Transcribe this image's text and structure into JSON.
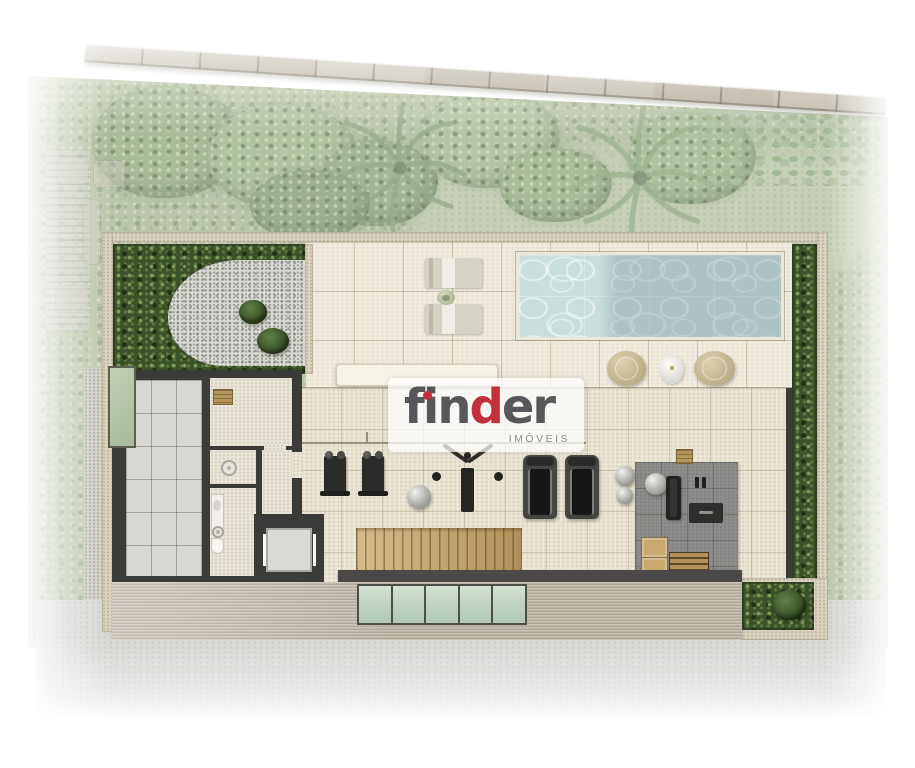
{
  "watermark": {
    "word_part1": "fin",
    "accent_letter": "d",
    "word_part2": "er",
    "subtitle": "IMÓVEIS"
  },
  "palette": {
    "logo-gray": "#57585a",
    "logo-red": "#c2303b",
    "water": "#c9dedd",
    "veg-base": "#a9b795",
    "garden": "#3e5229",
    "wall-dark": "#3b3b39",
    "cream-wall": "#d9d3bf",
    "deck": "#f0ebde",
    "interior": "#ebe5d6",
    "platform": "#8c8c8a",
    "wood": "#c9a567",
    "glass": "#c6d6c6",
    "stone": "#b6ad9d",
    "pavement": "#d4d6d2"
  },
  "counts": {
    "glass_panels": 5,
    "sun_loungers": 2,
    "treadmills": 2,
    "dumbbell_racks": 2,
    "poufs": 2
  }
}
